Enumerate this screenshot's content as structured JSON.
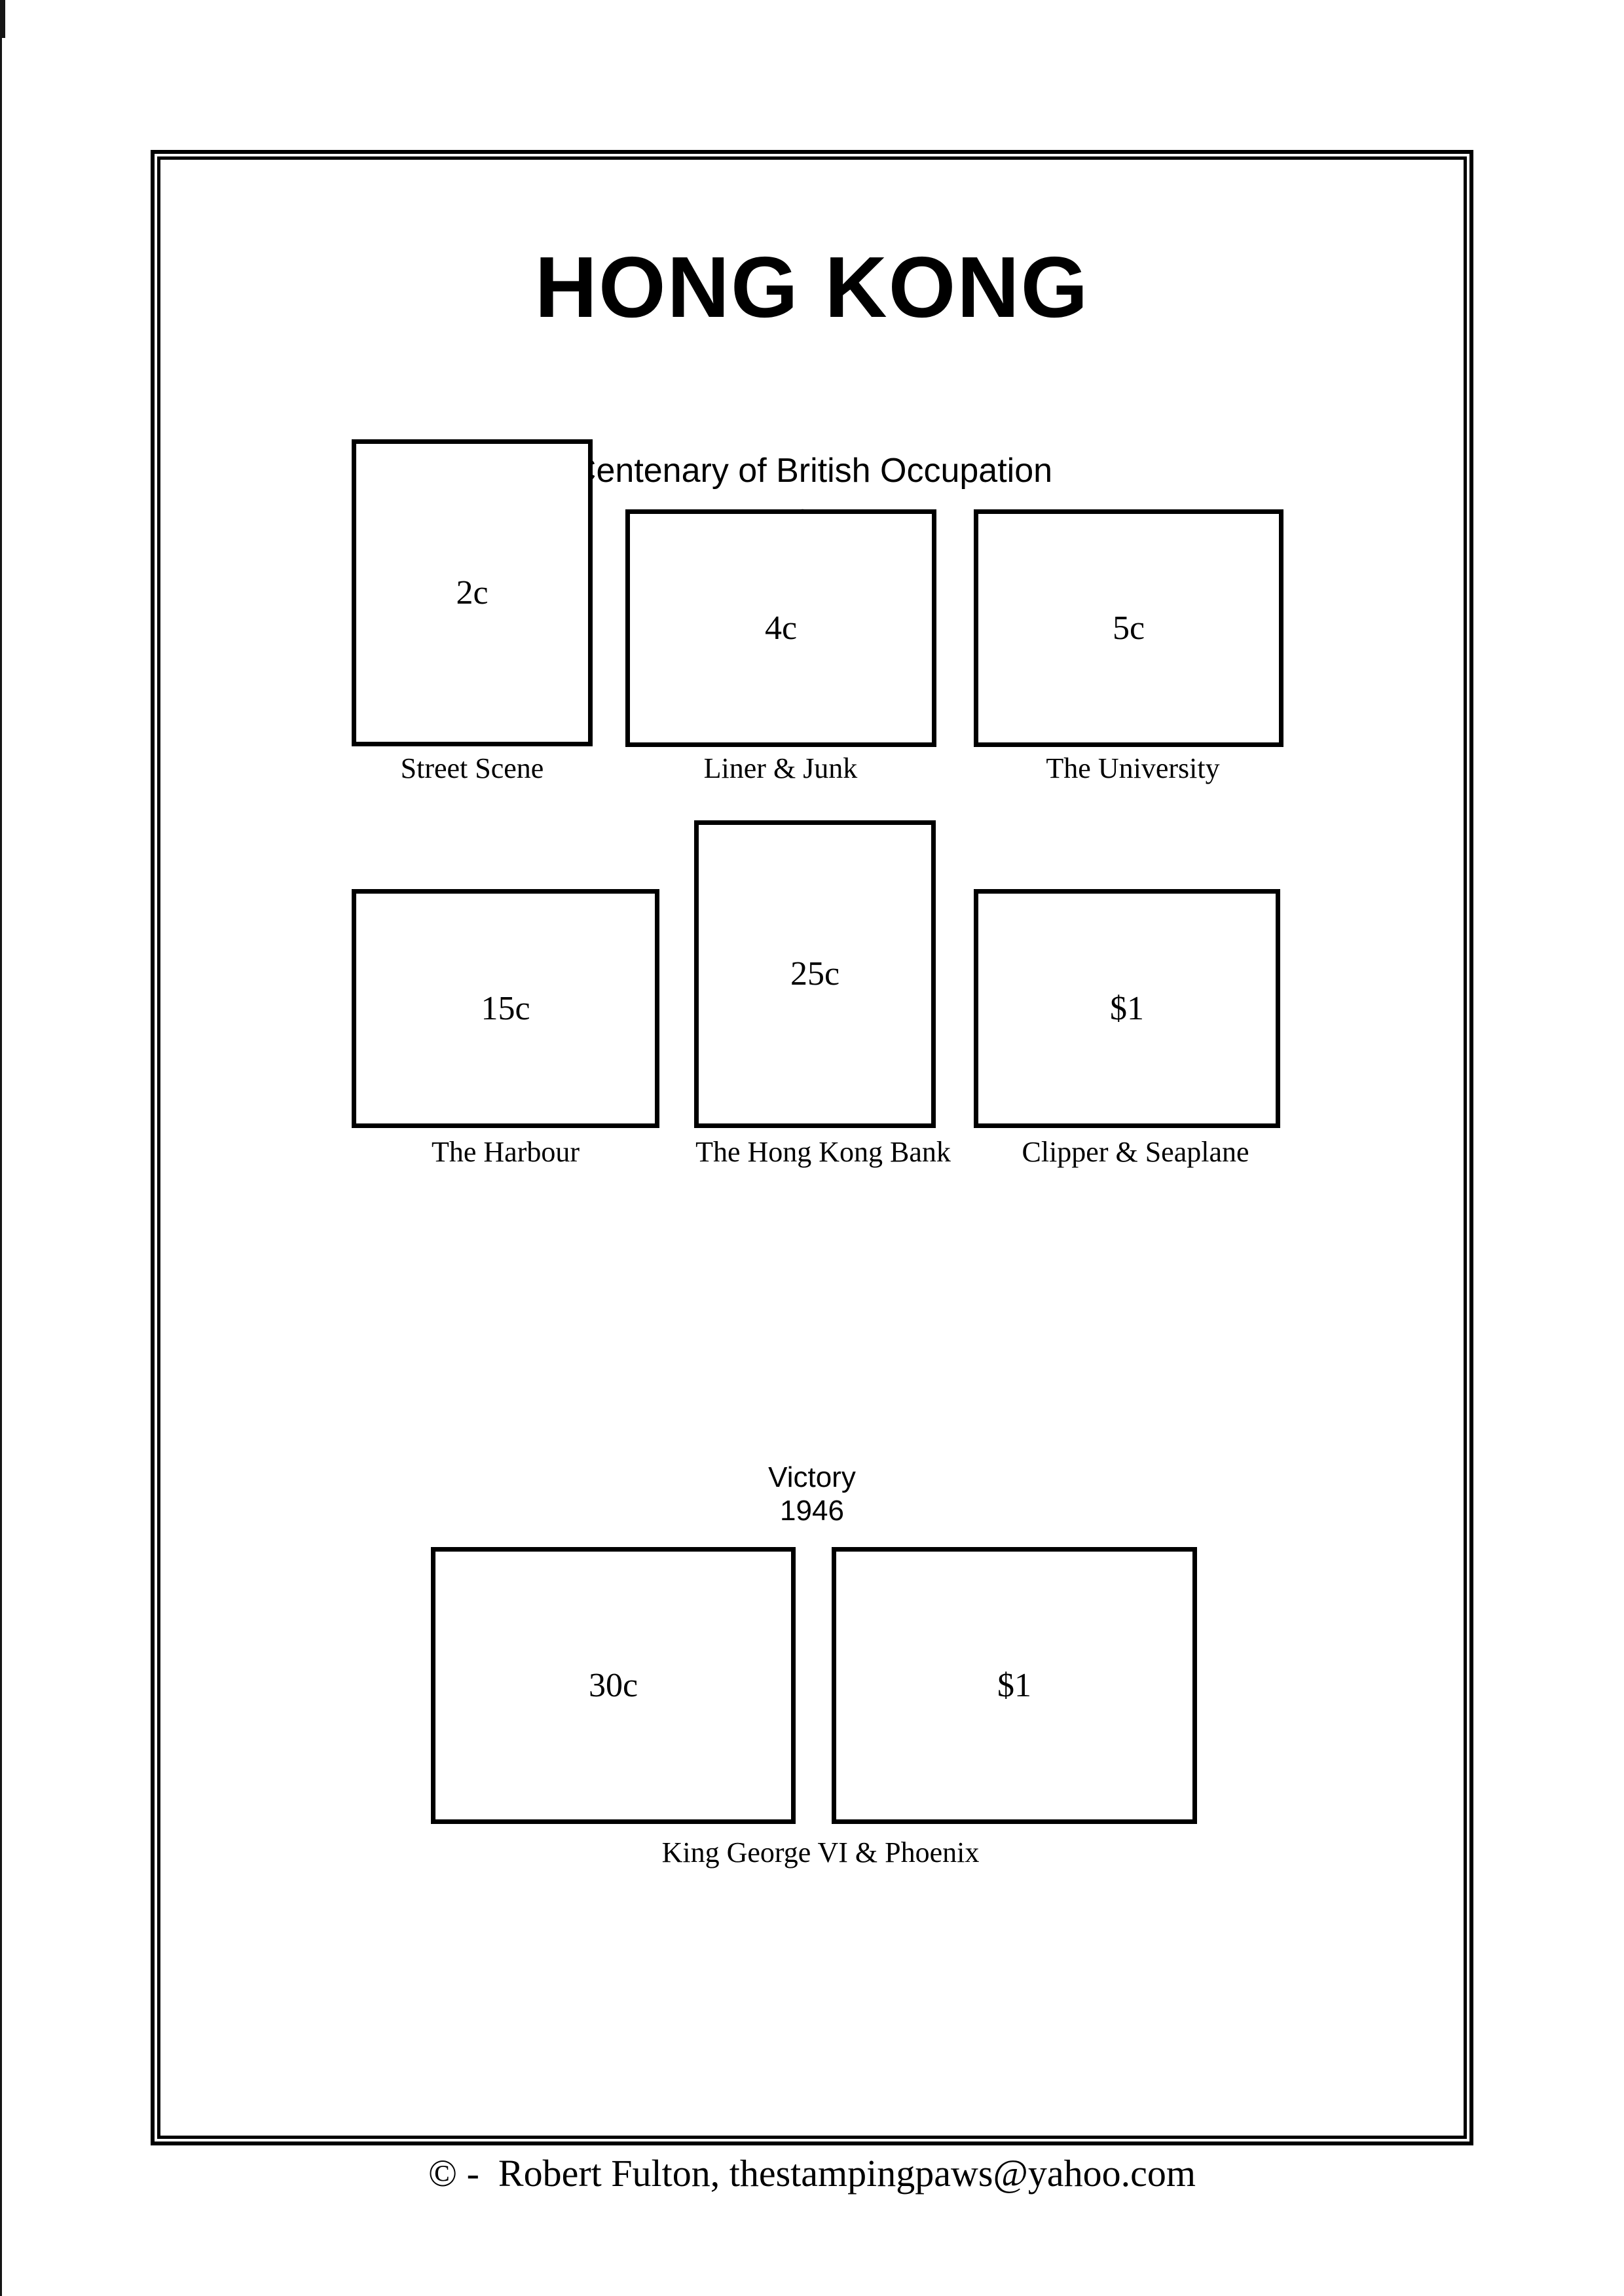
{
  "page": {
    "title": "HONG KONG",
    "footer_credit": "© -  Robert Fulton, thestampingpaws@yahoo.com"
  },
  "sections": [
    {
      "heading": "Centenary of British Occupation",
      "year": "1941",
      "stamps": [
        {
          "denomination": "2c",
          "caption": "Street Scene"
        },
        {
          "denomination": "4c",
          "caption": "Liner & Junk"
        },
        {
          "denomination": "5c",
          "caption": "The University"
        },
        {
          "denomination": "15c",
          "caption": "The Harbour"
        },
        {
          "denomination": "25c",
          "caption": "The Hong Kong Bank"
        },
        {
          "denomination": "$1",
          "caption": "Clipper & Seaplane"
        }
      ]
    },
    {
      "heading": "Victory",
      "year": "1946",
      "stamps": [
        {
          "denomination": "30c"
        },
        {
          "denomination": "$1"
        }
      ],
      "shared_caption": "King George VI & Phoenix"
    }
  ]
}
